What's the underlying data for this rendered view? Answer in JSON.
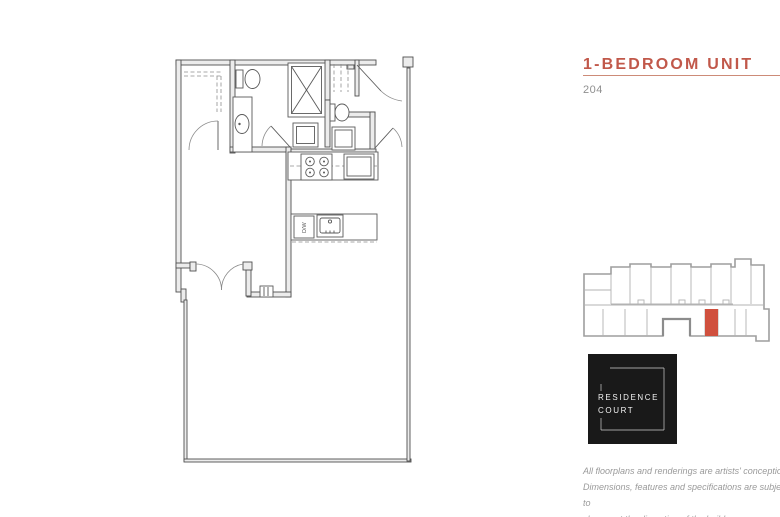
{
  "unit": {
    "title": "1-BEDROOM UNIT",
    "number": "204"
  },
  "brand": {
    "line1": "RESIDENCE",
    "line2": "COURT"
  },
  "floorplan": {
    "labels": {
      "dishwasher": "D/W"
    }
  },
  "keyplan": {
    "highlighted_unit": "204",
    "highlight_color": "#D0503E"
  },
  "disclaimer": {
    "lines": [
      "All floorplans and renderings are artists' conception.",
      "Dimensions, features and specifications are subject to",
      "change at the discretion of the builder."
    ]
  },
  "colors": {
    "accent": "#C1584A",
    "accent_rule": "#CD8B78",
    "logo_background": "#191919",
    "wall_line": "#4F4F4F",
    "keyplan_line": "#9E9E9E"
  }
}
